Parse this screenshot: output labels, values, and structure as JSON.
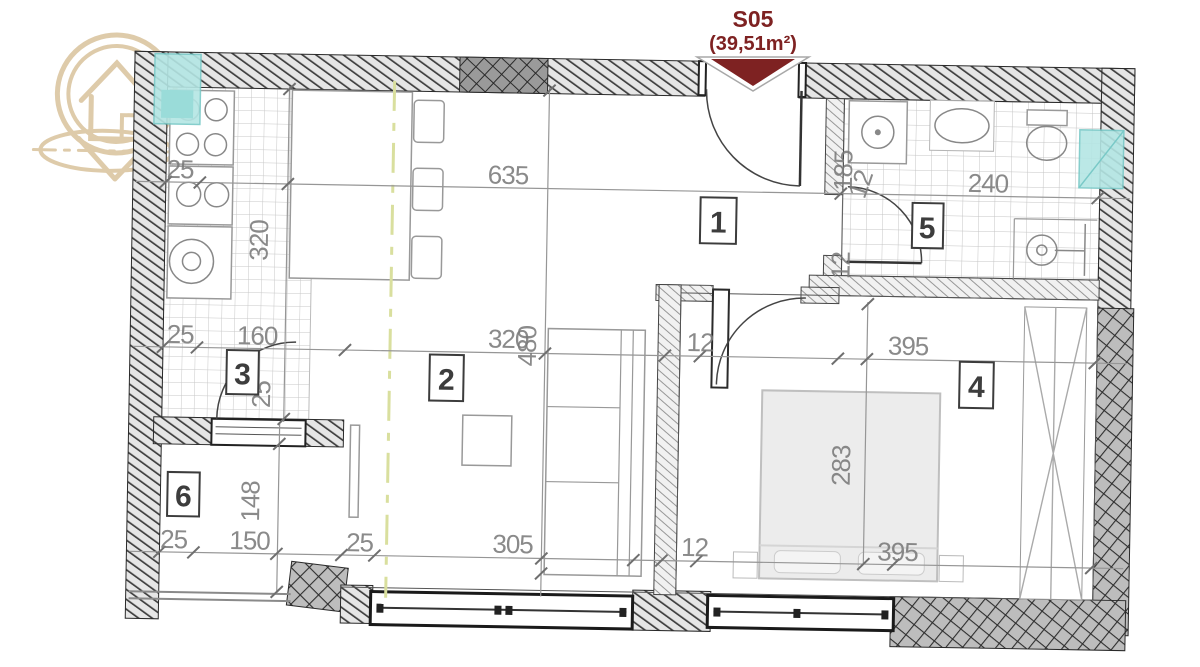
{
  "header": {
    "unit_code": "S05",
    "unit_area": "(39,51m²)"
  },
  "rooms": [
    {
      "number": "1"
    },
    {
      "number": "2"
    },
    {
      "number": "3"
    },
    {
      "number": "4"
    },
    {
      "number": "5"
    },
    {
      "number": "6"
    }
  ],
  "dims": {
    "kitchen_top": "25",
    "hall_width": "635",
    "bath_height": "185",
    "bath_wall_top": "12",
    "bath_width": "240",
    "kitchen_height": "320",
    "left_25": "25",
    "kitchen_width": "160",
    "living_width": "320",
    "living_height": "480",
    "bedroom_wall": "12",
    "bedroom_width": "395",
    "door3_width": "25",
    "bath_wall_mid": "12",
    "bedroom_height": "283",
    "balcony_height": "148",
    "balcony_left": "25",
    "balcony_width": "150",
    "balcony_right": "25",
    "living_bottom": "305",
    "bedroom_wall_bottom": "12",
    "bedroom_bottom": "395"
  },
  "colors": {
    "accent": "#7E2222",
    "logo_gold": "#D6BD93",
    "window_teal": "#B4E6E4",
    "dim_text": "#7A7A7A"
  }
}
